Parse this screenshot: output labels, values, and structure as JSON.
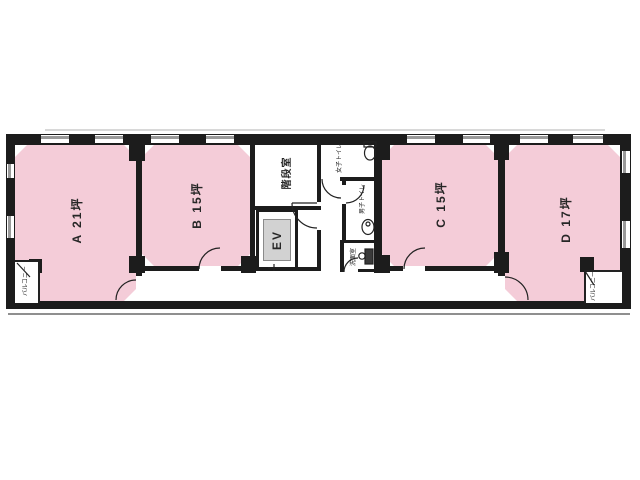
{
  "floorplan": {
    "rooms": [
      {
        "id": "A",
        "label": "A 21坪"
      },
      {
        "id": "B",
        "label": "B 15坪"
      },
      {
        "id": "C",
        "label": "C 15坪"
      },
      {
        "id": "D",
        "label": "D 17坪"
      }
    ],
    "stairwell": {
      "label": "階段室"
    },
    "elevator": {
      "label": "EV"
    },
    "toilet_women": {
      "label": "女子トイレ"
    },
    "toilet_men": {
      "label": "男子トイレ"
    },
    "washroom": {
      "label": "洗面室"
    },
    "balcony_left": {
      "label": "バルコニー"
    },
    "balcony_right": {
      "label": "バルコニー"
    },
    "colors": {
      "room_fill": "#f4ccd8",
      "wall": "#1c1c1c",
      "window_gray": "#9a9a9a",
      "elevator_fill": "#d2d2d2"
    }
  }
}
